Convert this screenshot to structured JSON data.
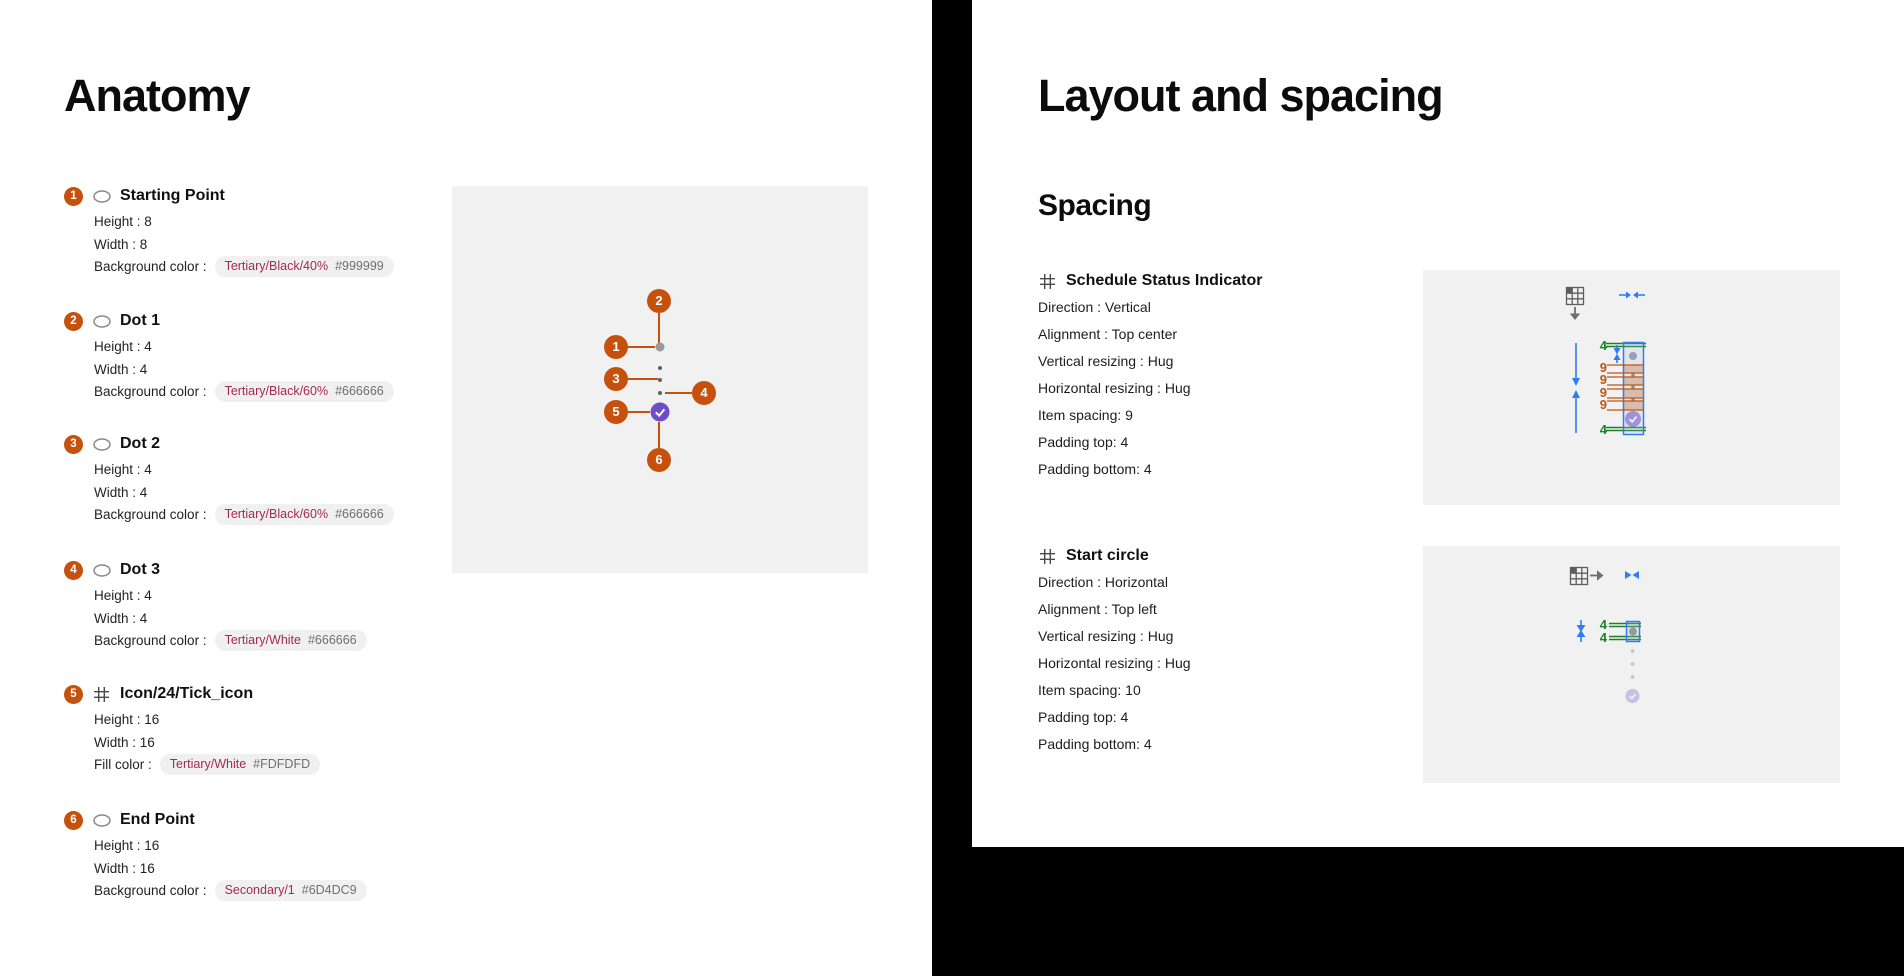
{
  "colors": {
    "badge_orange": "#C5510D",
    "token_red": "#A52A52",
    "green": "#1B8126",
    "blue": "#2F7CF6",
    "spacing_orange": "#C05511",
    "purple": "#6D4DC9",
    "starting_gray": "#999999",
    "dot_gray": "#666666",
    "panel_gray": "#F1F1F2"
  },
  "anatomy": {
    "title": "Anatomy",
    "items": [
      {
        "num": "1",
        "icon": "ellipse",
        "name": "Starting Point",
        "rows": [
          "Height : 8",
          "Width : 8"
        ],
        "color": {
          "label": "Background color :",
          "token": "Tertiary/Black/40%",
          "hex": "#999999"
        }
      },
      {
        "num": "2",
        "icon": "ellipse",
        "name": "Dot 1",
        "rows": [
          "Height : 4",
          "Width : 4"
        ],
        "color": {
          "label": "Background color :",
          "token": "Tertiary/Black/60%",
          "hex": "#666666"
        }
      },
      {
        "num": "3",
        "icon": "ellipse",
        "name": "Dot 2",
        "rows": [
          "Height : 4",
          "Width : 4"
        ],
        "color": {
          "label": "Background color :",
          "token": "Tertiary/Black/60%",
          "hex": "#666666"
        }
      },
      {
        "num": "4",
        "icon": "ellipse",
        "name": "Dot 3",
        "rows": [
          "Height : 4",
          "Width : 4"
        ],
        "color": {
          "label": "Background color :",
          "token": "Tertiary/White",
          "hex": "#666666"
        }
      },
      {
        "num": "5",
        "icon": "frame",
        "name": "Icon/24/Tick_icon",
        "rows": [
          "Height : 16",
          "Width : 16"
        ],
        "color": {
          "label": "Fill color :",
          "token": "Tertiary/White",
          "hex": "#FDFDFD"
        }
      },
      {
        "num": "6",
        "icon": "ellipse",
        "name": "End Point",
        "rows": [
          "Height : 16",
          "Width : 16"
        ],
        "color": {
          "label": "Background color :",
          "token": "Secondary/1",
          "hex": "#6D4DC9"
        }
      }
    ],
    "diagram": {
      "badges": [
        "1",
        "2",
        "3",
        "4",
        "5",
        "6"
      ]
    }
  },
  "layout": {
    "title": "Layout and spacing",
    "subtitle": "Spacing",
    "sections": [
      {
        "name": "Schedule Status Indicator",
        "rows": [
          "Direction : Vertical",
          "Alignment : Top center",
          "Vertical resizing : Hug",
          "Horizontal resizing : Hug",
          "Item spacing: 9",
          "Padding top: 4",
          "Padding bottom: 4"
        ]
      },
      {
        "name": "Start circle",
        "rows": [
          "Direction : Horizontal",
          "Alignment : Top left",
          "Vertical resizing : Hug",
          "Horizontal resizing : Hug",
          "Item spacing: 10",
          "Padding top: 4",
          "Padding bottom: 4"
        ]
      }
    ],
    "diagram1": {
      "padding_top": "4",
      "gaps": [
        "9",
        "9",
        "9",
        "9"
      ],
      "padding_bottom": "4"
    },
    "diagram2": {
      "padding_top": "4",
      "padding_bottom": "4"
    }
  }
}
